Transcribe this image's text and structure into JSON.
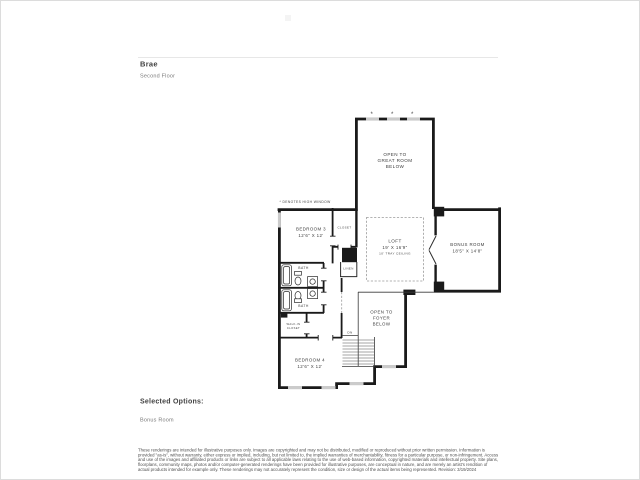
{
  "page": {
    "title": "Brae",
    "subtitle": "Second Floor",
    "selected_options_heading": "Selected Options:",
    "selected_option": "Bonus Room",
    "disclaimer": "These renderings are intended for illustrative purposes only. Images are copyrighted and may not be distributed, modified or reproduced without prior written permission. Information is provided \"as-is\", without warranty, either express or implied, including, but not limited to, the implied warranties of merchantability, fitness for a particular purpose, or non-infringement. Access and use of the images and affiliated products or links are subject to all applicable laws relating to the use of web-based information, copyrighted materials and intellectual property. Site plans, floorplans, community maps, photos and/or computer-generated renderings have been provided for illustrative purposes, are conceptual in nature, and are merely an artist's rendition of actual products intended for example only. These renderings may not accurately represent the condition, size or design of the actual items being represented. Revision: 3/19/2024"
  },
  "plan": {
    "high_window_note": "* DENOTES HIGH WINDOW",
    "high_window_marker": "*",
    "rooms": {
      "open_great_1": "OPEN TO",
      "open_great_2": "GREAT ROOM",
      "open_great_3": "BELOW",
      "bedroom3_name": "BEDROOM 3",
      "bedroom3_dims": "12'6\" X 12'",
      "closet": "CLOSET",
      "loft_name": "LOFT",
      "loft_dims": "19' X 16'9\"",
      "loft_ceiling": "10' TRAY CEILING",
      "bonus_name": "BONUS ROOM",
      "bonus_dims": "18'5\" X 14'8\"",
      "linen": "LINEN",
      "bath_upper": "BATH",
      "bath_lower": "BATH",
      "walkin_1": "WALK-IN",
      "walkin_2": "CLOSET",
      "bedroom4_name": "BEDROOM 4",
      "bedroom4_dims": "12'6\" X 12'",
      "open_foyer_1": "OPEN TO",
      "open_foyer_2": "FOYER",
      "open_foyer_3": "BELOW",
      "stairs_dn": "DN"
    },
    "colors": {
      "wall": "#1a1a1a",
      "window_fill": "#cbcbcb",
      "tray_dash": "#9a9a9a",
      "label": "#3d3d3d"
    }
  }
}
